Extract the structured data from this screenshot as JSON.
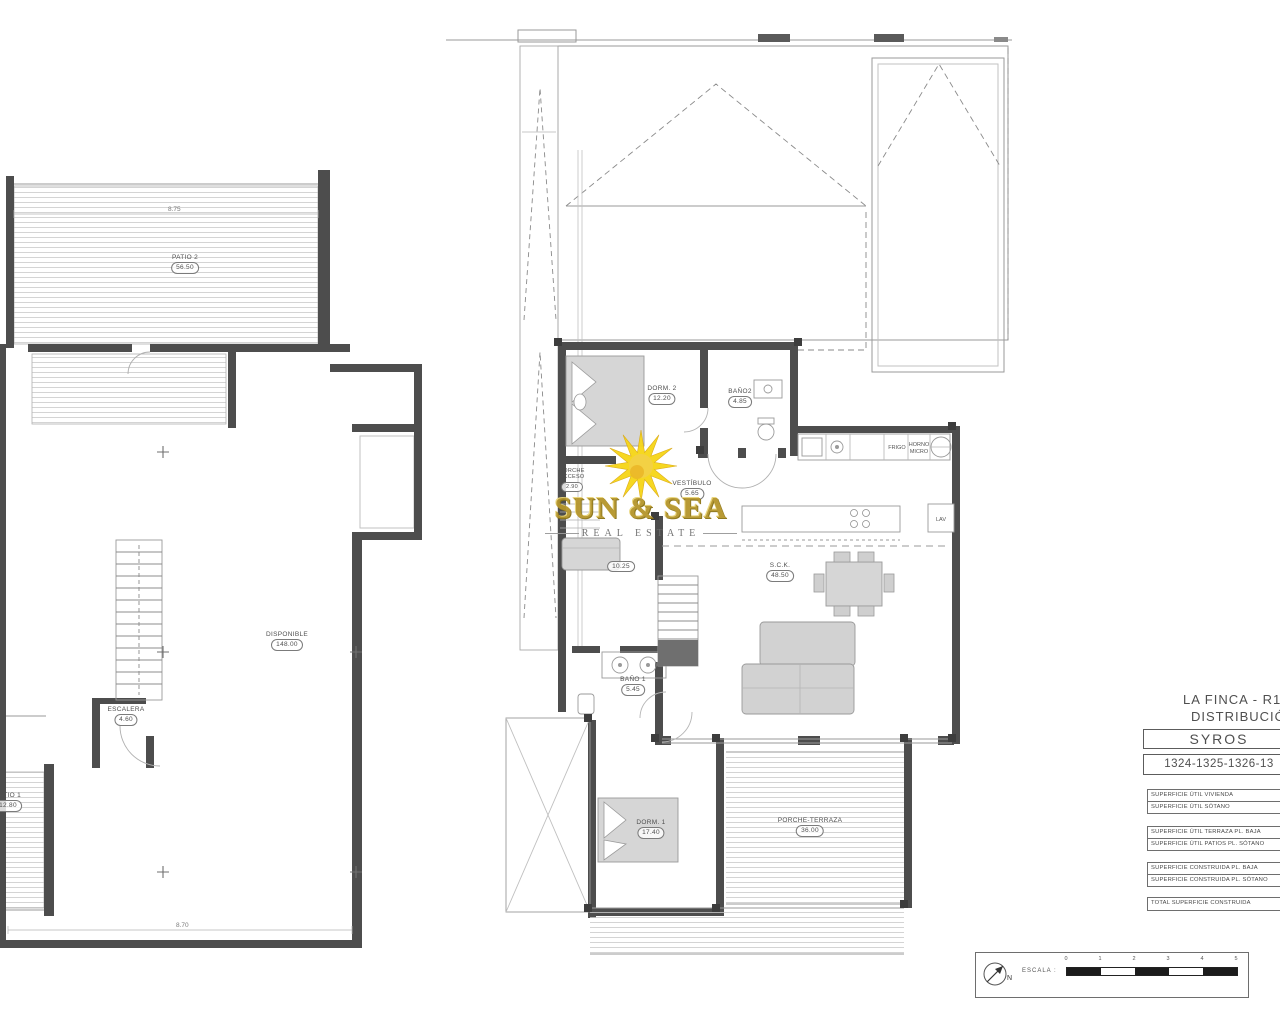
{
  "watermark": {
    "line1": "SUN & SEA",
    "line2": "REAL ESTATE"
  },
  "title_block": {
    "project_line1": "LA FINCA - R13",
    "project_line2": "DISTRIBUCIÓN",
    "model": "SYROS",
    "plots": "1324-1325-1326-13",
    "rows": [
      "SUPERFICIE ÚTIL VIVIENDA",
      "SUPERFICIE ÚTIL SÓTANO",
      "SUPERFICIE ÚTIL TERRAZA PL. BAJA",
      "SUPERFICIE ÚTIL PATIOS PL. SÓTANO",
      "SUPERFICIE CONSTRUIDA PL. BAJA",
      "SUPERFICIE CONSTRUIDA PL. SÓTANO",
      "TOTAL SUPERFICIE CONSTRUIDA"
    ]
  },
  "scale_box": {
    "north_label": "N",
    "scale_label": "ESCALA :",
    "ticks": [
      "0",
      "1",
      "2",
      "3",
      "4",
      "5"
    ]
  },
  "plan_sotano": {
    "rooms": {
      "patio2": {
        "name": "PATIO 2",
        "area": "56.50"
      },
      "disponible": {
        "name": "DISPONIBLE",
        "area": "148.00"
      },
      "escalera": {
        "name": "ESCALERA",
        "area": "4.60"
      },
      "patio1": {
        "name": "PATIO 1",
        "area": "12.80"
      }
    },
    "dimensions": {
      "top": "8.75",
      "bottom": "8.70"
    }
  },
  "plan_baja": {
    "rooms": {
      "dorm2": {
        "name": "DORM. 2",
        "area": "12.20"
      },
      "bano2": {
        "name": "BAÑO2",
        "area": "4.85"
      },
      "vestibulo": {
        "name": "VESTÍBULO",
        "area": "5.65"
      },
      "porche_acceso": {
        "name": "PORCHE ACCESO",
        "area": "2.90"
      },
      "salita": {
        "area": "10.25"
      },
      "sck": {
        "name": "S.C.K.",
        "area": "48.50"
      },
      "bano1": {
        "name": "BAÑO 1",
        "area": "5.45"
      },
      "dorm1": {
        "name": "DORM. 1",
        "area": "17.40"
      },
      "porche_terraza": {
        "name": "PORCHE-TERRAZA",
        "area": "36.00"
      }
    },
    "appliances": {
      "fridge": "FRIGO",
      "oven": "HORNO",
      "micro": "MICRO",
      "laundry": "LAV"
    }
  }
}
